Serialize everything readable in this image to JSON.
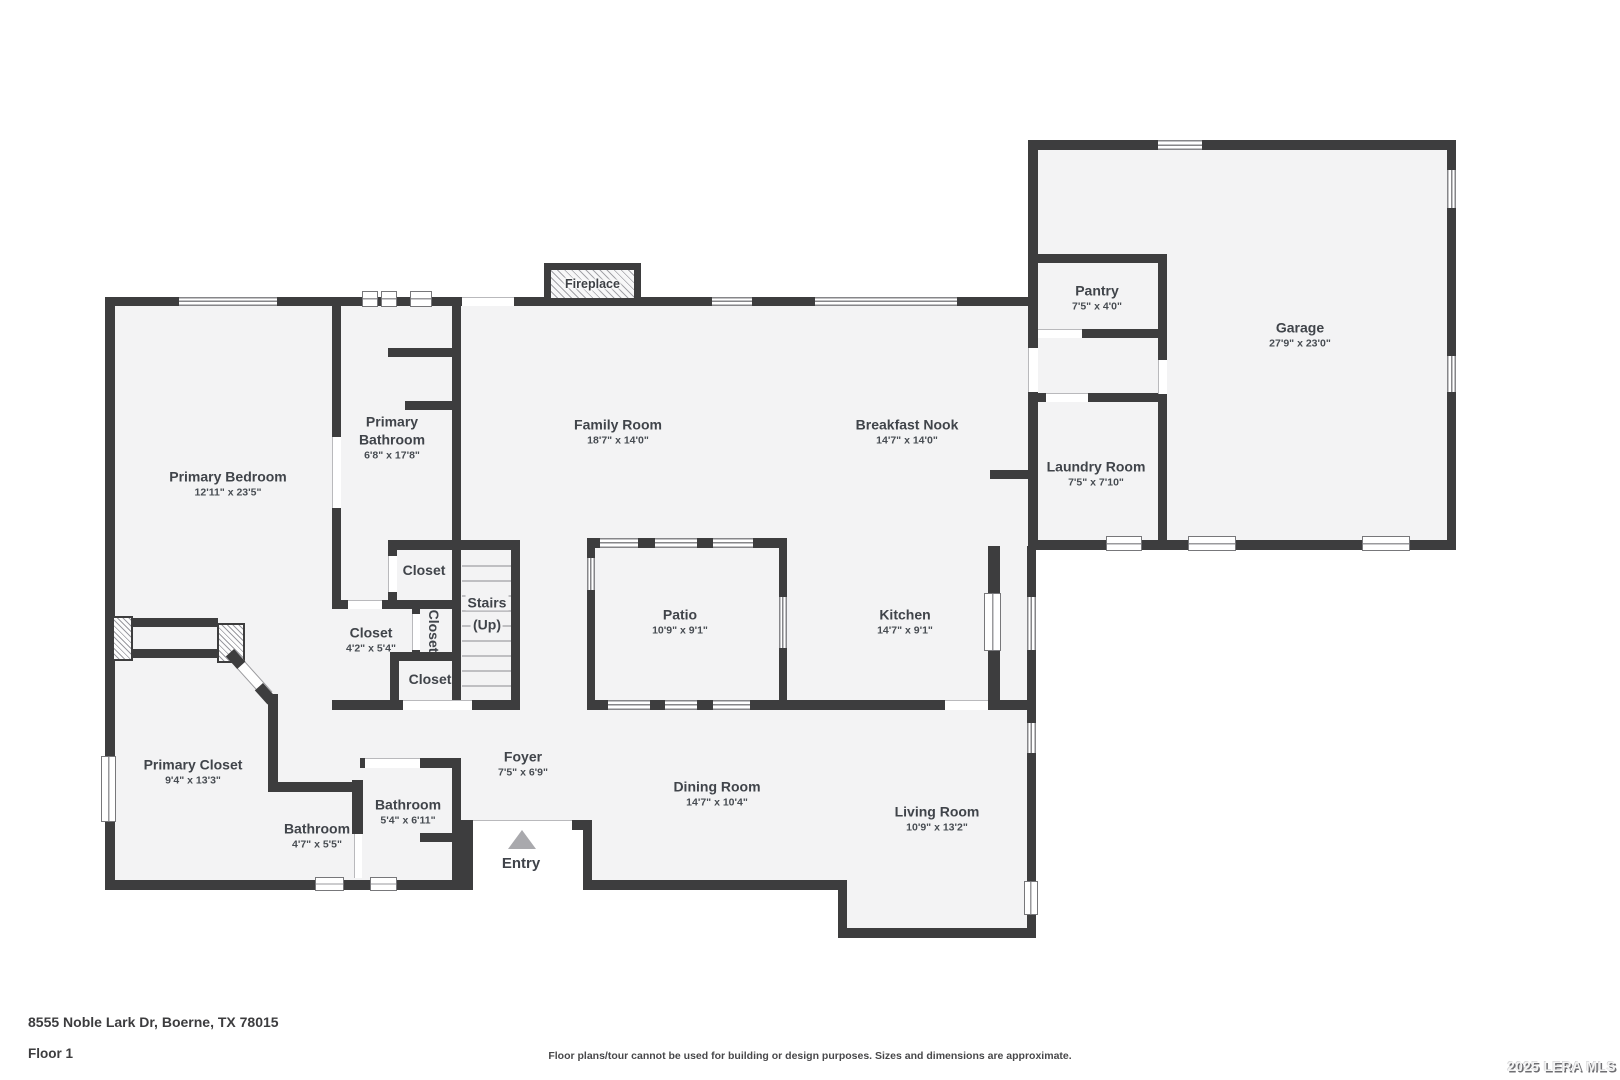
{
  "floorplan": {
    "rooms": [
      {
        "id": "primary-bedroom",
        "name": "Primary Bedroom",
        "dims": "12'11\" x 23'5\"",
        "x": 228,
        "y": 484
      },
      {
        "id": "primary-bathroom",
        "name": "Primary Bathroom",
        "dims": "6'8\" x 17'8\"",
        "x": 392,
        "y": 438,
        "w": 88,
        "wrap": true
      },
      {
        "id": "family-room",
        "name": "Family Room",
        "dims": "18'7\" x 14'0\"",
        "x": 618,
        "y": 432
      },
      {
        "id": "breakfast-nook",
        "name": "Breakfast Nook",
        "dims": "14'7\" x 14'0\"",
        "x": 907,
        "y": 432
      },
      {
        "id": "pantry",
        "name": "Pantry",
        "dims": "7'5\" x 4'0\"",
        "x": 1097,
        "y": 298
      },
      {
        "id": "garage",
        "name": "Garage",
        "dims": "27'9\" x 23'0\"",
        "x": 1300,
        "y": 335
      },
      {
        "id": "laundry-room",
        "name": "Laundry Room",
        "dims": "7'5\" x 7'10\"",
        "x": 1096,
        "y": 474
      },
      {
        "id": "closet-upper",
        "name": "Closet",
        "x": 424,
        "y": 571
      },
      {
        "id": "closet-hall",
        "name": "Closet",
        "dims": "4'2\" x 5'4\"",
        "x": 371,
        "y": 640
      },
      {
        "id": "closet-mid",
        "name": "Closet",
        "x": 433,
        "y": 631,
        "vertical": true
      },
      {
        "id": "closet-lower",
        "name": "Closet",
        "x": 430,
        "y": 680
      },
      {
        "id": "patio",
        "name": "Patio",
        "dims": "10'9\" x 9'1\"",
        "x": 680,
        "y": 622
      },
      {
        "id": "kitchen",
        "name": "Kitchen",
        "dims": "14'7\" x 9'1\"",
        "x": 905,
        "y": 622
      },
      {
        "id": "primary-closet",
        "name": "Primary Closet",
        "dims": "9'4\" x 13'3\"",
        "x": 193,
        "y": 772
      },
      {
        "id": "bathroom-small",
        "name": "Bathroom",
        "dims": "4'7\" x 5'5\"",
        "x": 317,
        "y": 836
      },
      {
        "id": "bathroom-hall",
        "name": "Bathroom",
        "dims": "5'4\" x 6'11\"",
        "x": 408,
        "y": 812
      },
      {
        "id": "foyer",
        "name": "Foyer",
        "dims": "7'5\" x 6'9\"",
        "x": 523,
        "y": 764
      },
      {
        "id": "dining-room",
        "name": "Dining Room",
        "dims": "14'7\" x 10'4\"",
        "x": 717,
        "y": 794
      },
      {
        "id": "living-room",
        "name": "Living Room",
        "dims": "10'9\" x 13'2\"",
        "x": 937,
        "y": 819
      }
    ],
    "stairs": {
      "line1": "Stairs",
      "line2": "(Up)",
      "x": 487,
      "y": 614
    },
    "fireplace_label": "Fireplace",
    "entry_label": "Entry"
  },
  "footer": {
    "address": "8555 Noble Lark Dr, Boerne, TX 78015",
    "floor_label": "Floor 1",
    "disclaimer": "Floor plans/tour cannot be used for building or design purposes. Sizes and dimensions are approximate.",
    "watermark": "2025 LERA MLS"
  }
}
